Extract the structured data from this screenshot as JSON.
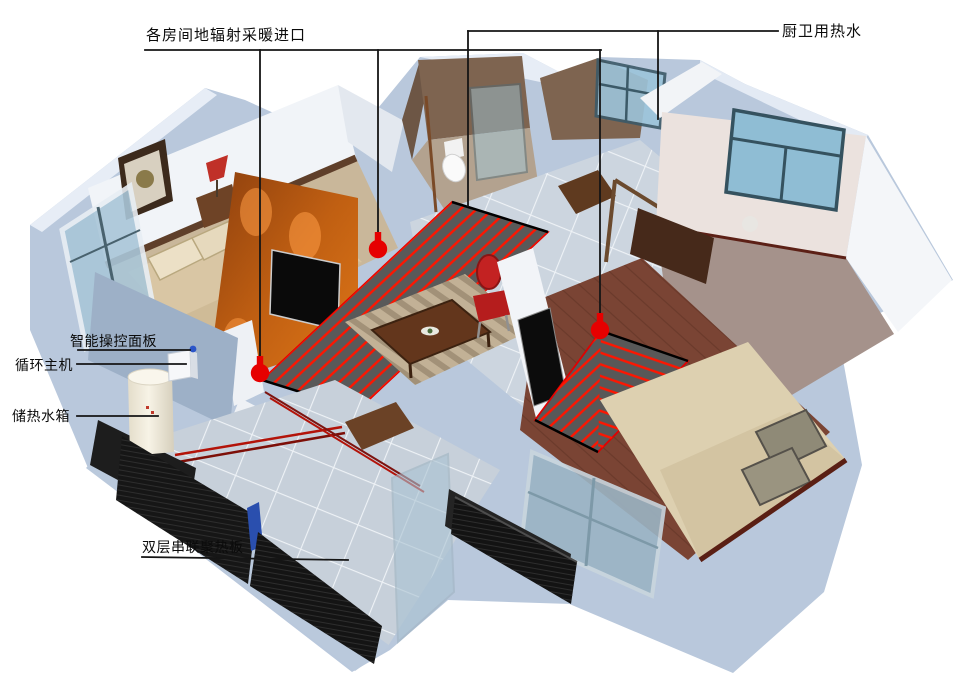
{
  "diagram": {
    "labels": {
      "room_heating_inlets": "各房间地辐射采暖进口",
      "kitchen_bath_hot_water": "厨卫用热水",
      "smart_control_panel": "智能操控面板",
      "circulation_host": "循环主机",
      "heat_storage_tank": "储热水箱",
      "double_series_heat_panel": "双层串联聚热板"
    },
    "markers": {
      "heating_inlet_pin_count": "3",
      "pin_color": "#e60000",
      "control_dot_color": "#2b55c8"
    },
    "colors": {
      "annotation_line": "#151515",
      "coil_red": "#ff1500",
      "panel_black": "#141414",
      "exterior_wall": "#b9c8dc",
      "orange_wall": "#c05f12",
      "background": "#ffffff"
    }
  }
}
